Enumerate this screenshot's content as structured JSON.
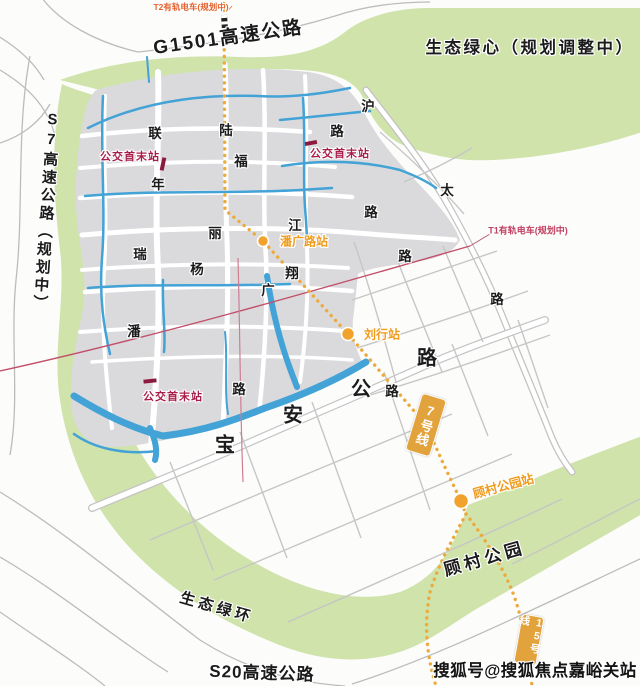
{
  "map": {
    "title_labels": {
      "g1501": "G1501高速公路",
      "s7": "S7高速公路（规划中）",
      "s20": "S20高速公路",
      "eco_heart": "生态绿心（规划调整中）",
      "eco_ring": "生态绿环",
      "gucun_park": "顾村公园"
    },
    "main_road_chars": [
      "宝",
      "安",
      "公",
      "路"
    ],
    "road_chars": [
      "联",
      "陆",
      "路",
      "沪",
      "福",
      "年",
      "太",
      "江",
      "丽",
      "瑞",
      "杨",
      "翔",
      "广",
      "路",
      "路",
      "路",
      "潘",
      "路",
      "路"
    ],
    "stations": {
      "panguang": "潘广路站",
      "liuhang": "刘行站",
      "gucun_park_station": "顾村公园站"
    },
    "bus_terminal_label": "公交首末站",
    "tram_labels": {
      "t2": "T2有轨电车(规划中)",
      "t1": "T1有轨电车(规划中)"
    },
    "metro_badges": {
      "line7": "7号线",
      "line15": "15号线"
    },
    "watermark": "搜狐号@搜狐焦点嘉峪关站",
    "colors": {
      "green": "#cfe3ab",
      "urban_grey": "#dadadd",
      "water_blue": "#43a2d6",
      "metro_orange": "#ecaa3c",
      "badge_orange": "#e2a23c",
      "station_text_orange": "#ef9c1e",
      "bus_red": "#a81e4a",
      "tram_line_red": "#c2506a"
    }
  }
}
